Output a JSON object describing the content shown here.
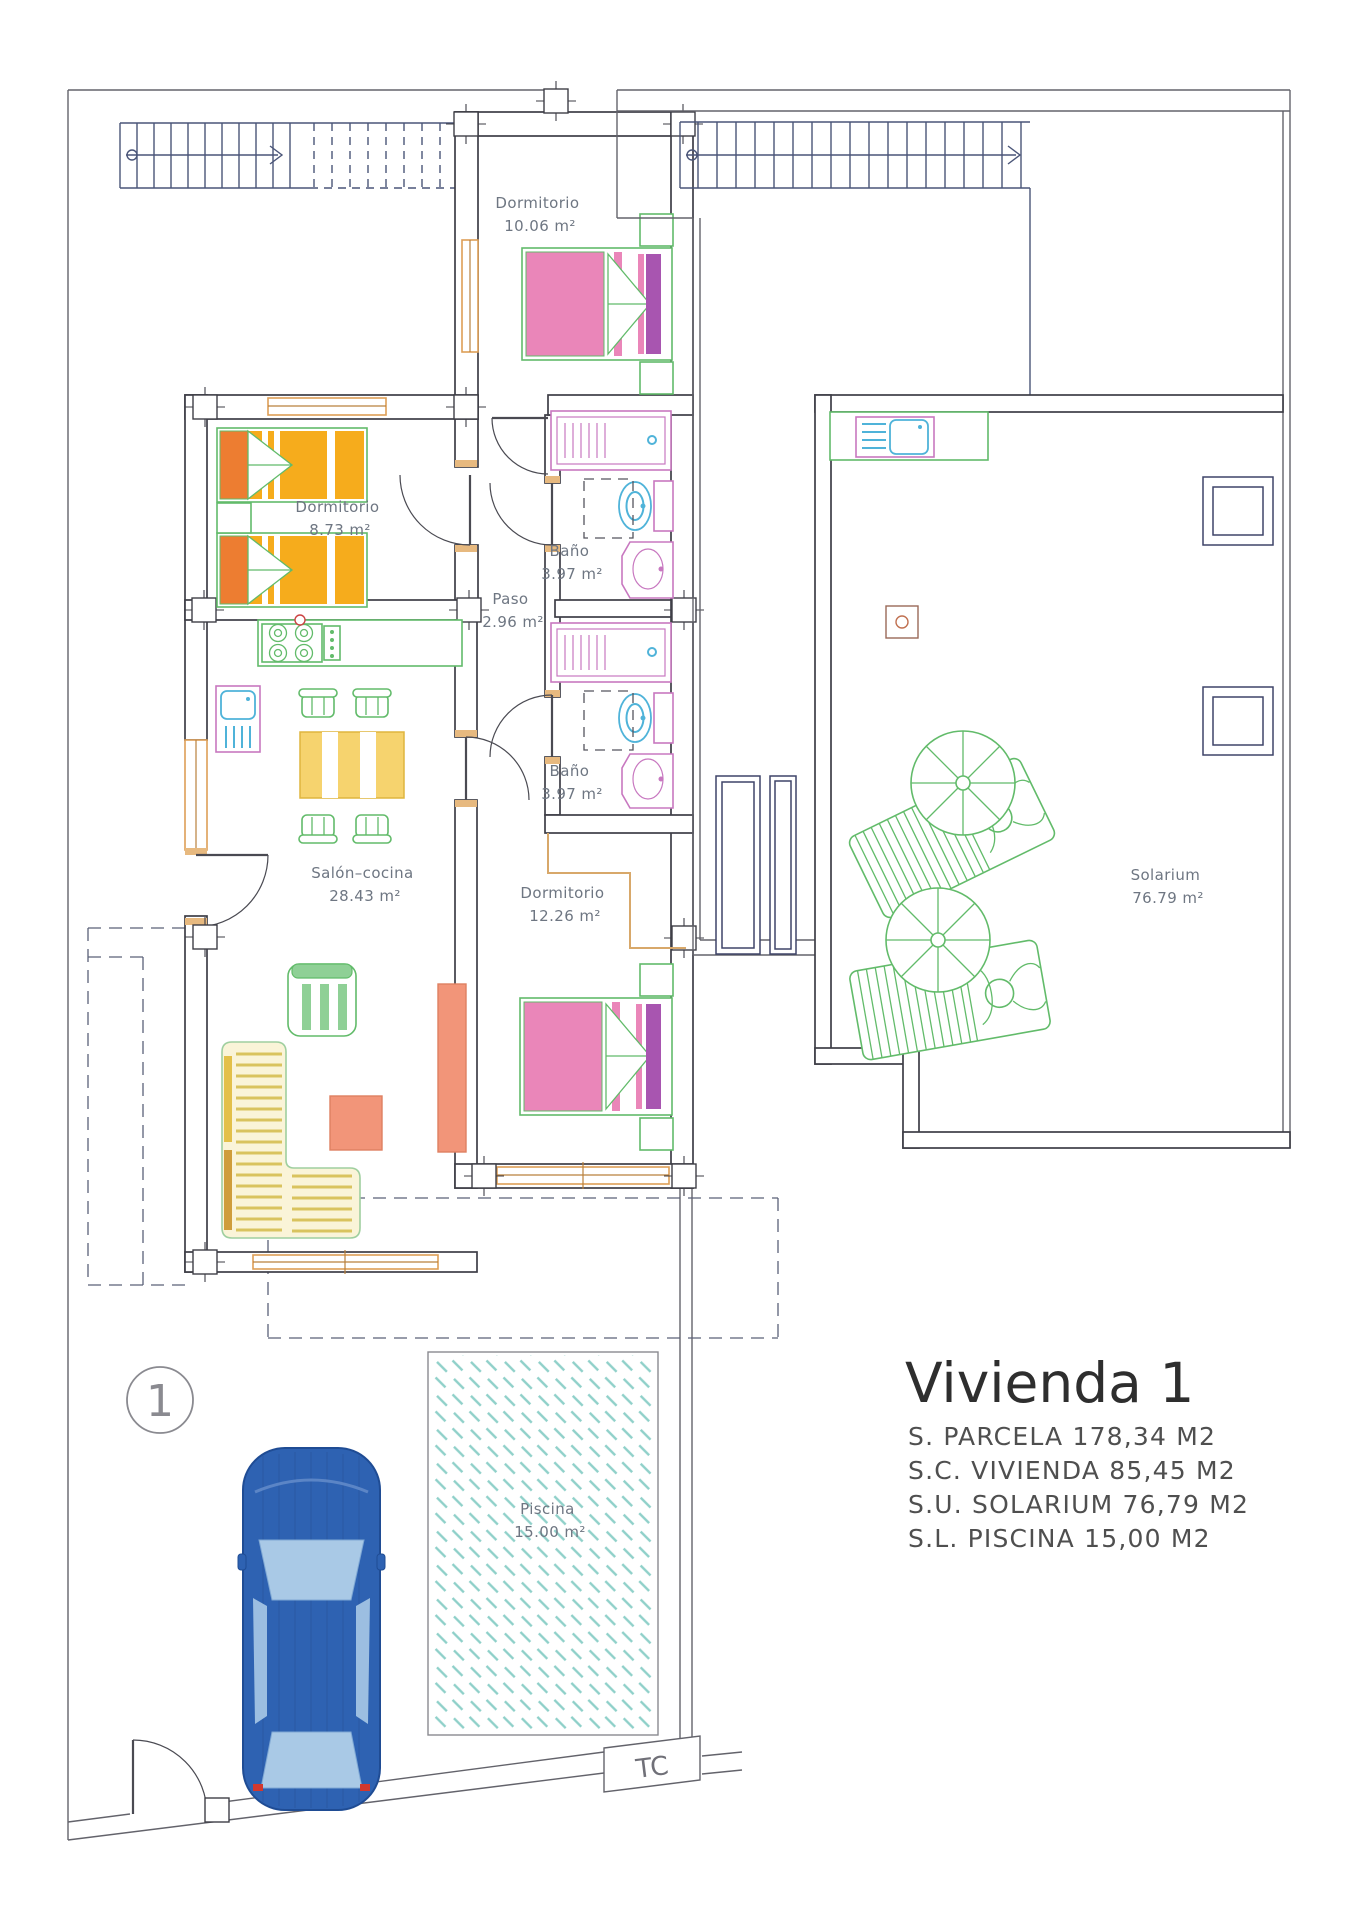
{
  "title": "Vivienda 1",
  "unit_marker": "1",
  "tc_label": "TC",
  "rooms": {
    "dormitorio1": {
      "name": "Dormitorio",
      "area": "10.06 m²"
    },
    "dormitorio2": {
      "name": "Dormitorio",
      "area": "8.73 m²"
    },
    "bano1": {
      "name": "Baño",
      "area": "3.97 m²"
    },
    "paso": {
      "name": "Paso",
      "area": "2.96 m²"
    },
    "bano2": {
      "name": "Baño",
      "area": "3.97 m²"
    },
    "salon": {
      "name": "Salón–cocina",
      "area": "28.43 m²"
    },
    "dormitorio3": {
      "name": "Dormitorio",
      "area": "12.26 m²"
    },
    "solarium": {
      "name": "Solarium",
      "area": "76.79 m²"
    },
    "piscina": {
      "name": "Piscina",
      "area": "15.00 m²"
    }
  },
  "summary": {
    "line1": "S.  PARCELA  178,34  M2",
    "line2": "S.C.  VIVIENDA  85,45  M2",
    "line3": "S.U.  SOLARIUM  76,79  M2",
    "line4": "S.L.  PISCINA  15,00  M2"
  },
  "colors": {
    "wall": "#3e3e46",
    "accent_green": "#62bb6a",
    "bed_pink": "#ea86b9",
    "bed_orange": "#f6ac1c",
    "fixture_pink": "#c878c0",
    "fixture_cyan": "#4fb3d9",
    "sofa_yellow": "#d9c35e",
    "furniture_salmon": "#f29579",
    "car_blue": "#2e62b2",
    "pool_teal": "#8fd0c9",
    "window_orange": "#dd9e56",
    "stair_navy": "#4a5578"
  }
}
